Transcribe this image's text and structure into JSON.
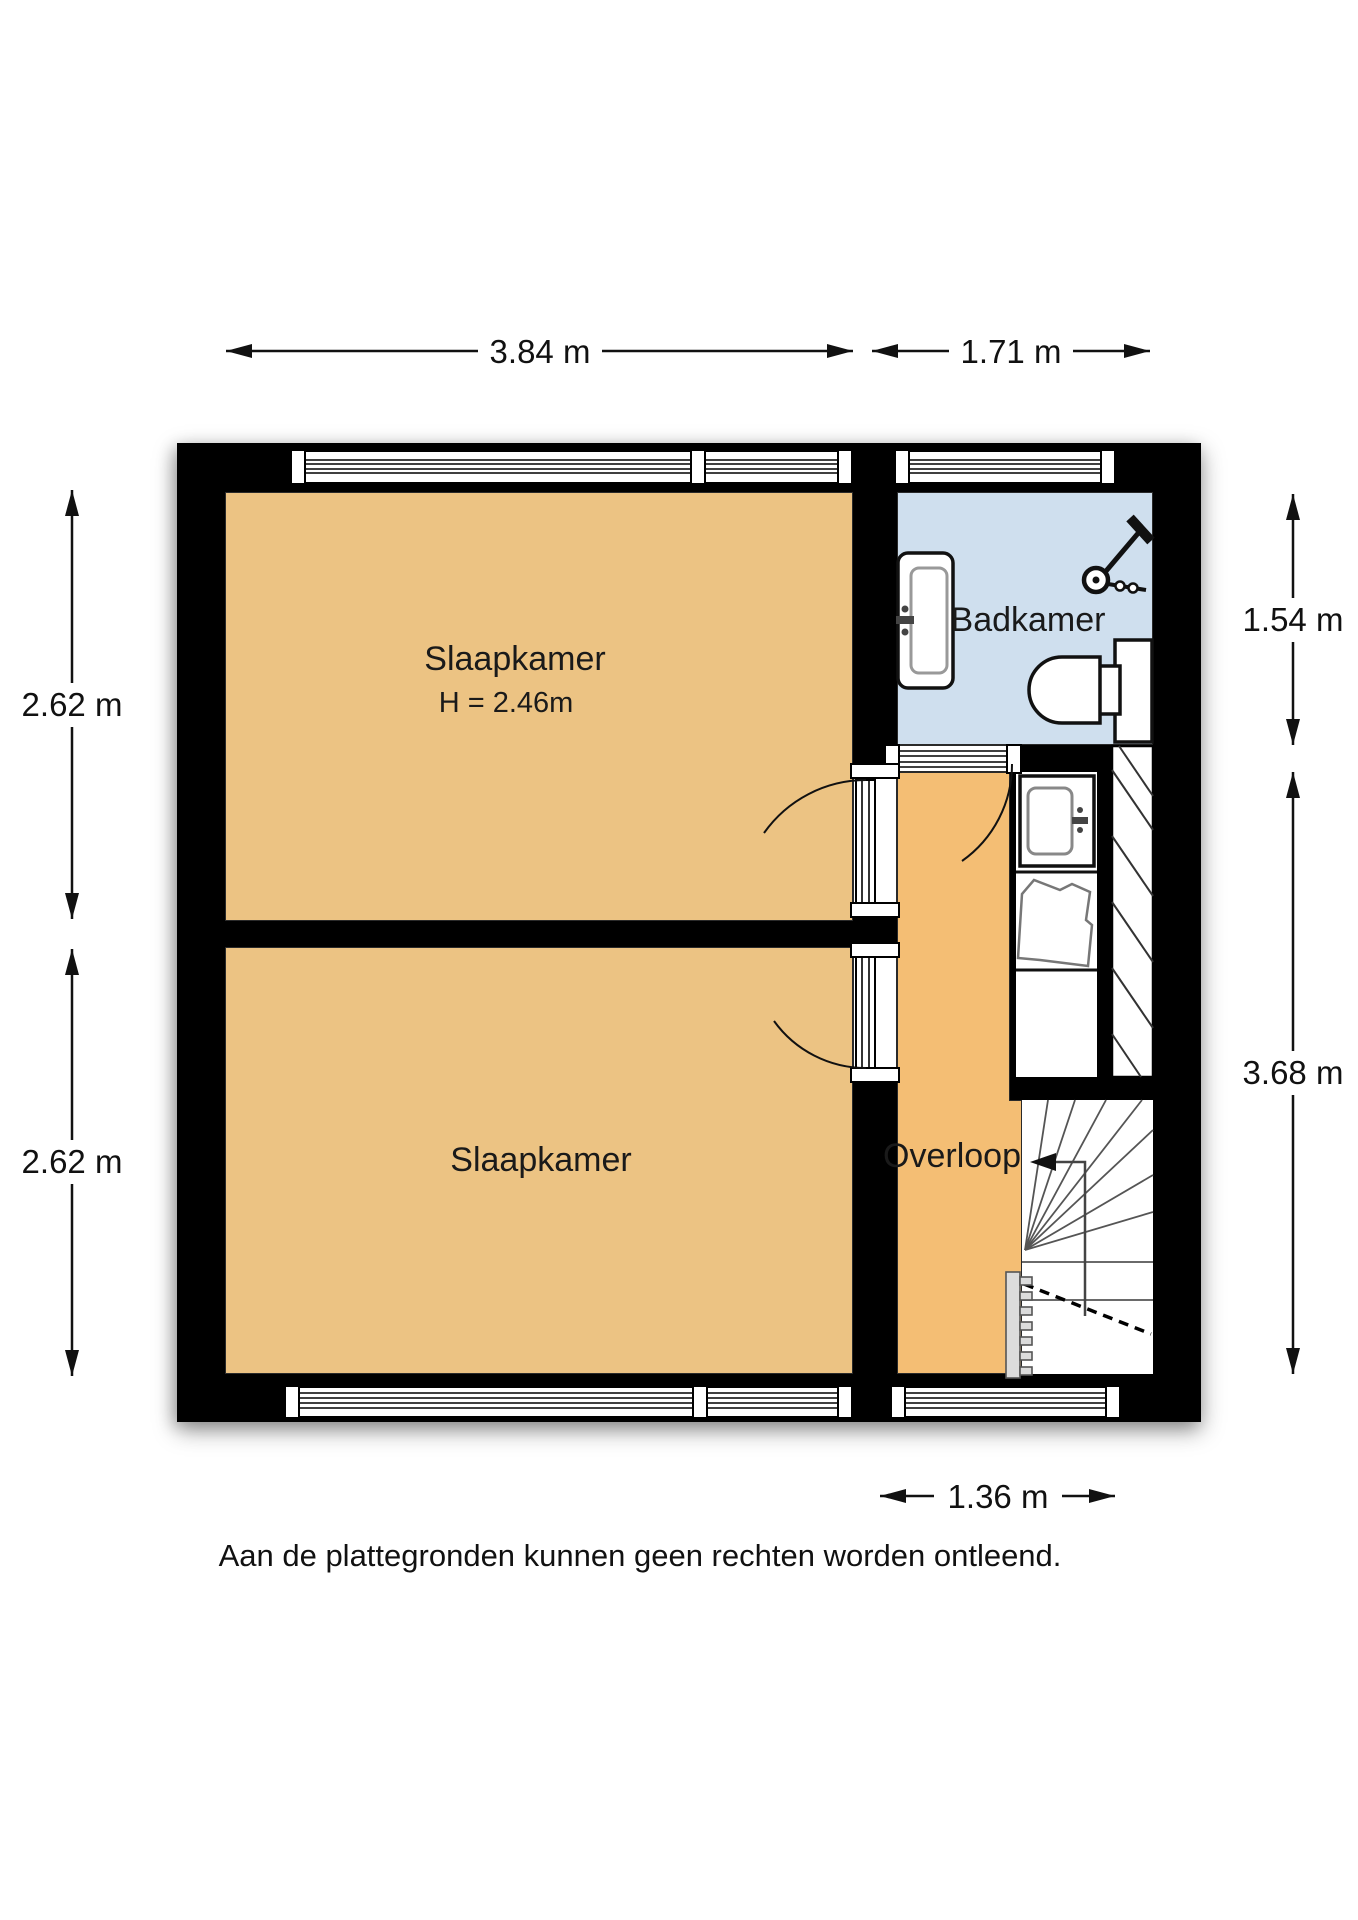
{
  "floorplan": {
    "rooms": {
      "slaapkamer_1": {
        "label": "Slaapkamer",
        "ceiling_height": "H = 2.46m"
      },
      "slaapkamer_2": {
        "label": "Slaapkamer"
      },
      "badkamer": {
        "label": "Badkamer"
      },
      "overloop": {
        "label": "Overloop"
      }
    },
    "dimensions": {
      "top_bedroom_width": "3.84 m",
      "top_bathroom_width": "1.71 m",
      "left_bedroom1_depth": "2.62 m",
      "left_bedroom2_depth": "2.62 m",
      "right_bathroom_depth": "1.54 m",
      "right_landing_depth": "3.68 m",
      "bottom_landing_window": "1.36 m"
    },
    "fixtures": [
      "sink-icon",
      "shower-icon",
      "toilet-icon",
      "washbasin-icon",
      "staircase-icon",
      "radiator-icon"
    ],
    "colors": {
      "bedroom_floor": "#ecc383",
      "landing_floor": "#f4be74",
      "bathroom_floor": "#cfdfee",
      "wall": "#000000"
    }
  },
  "disclaimer": "Aan de plattegronden kunnen geen rechten worden ontleend."
}
